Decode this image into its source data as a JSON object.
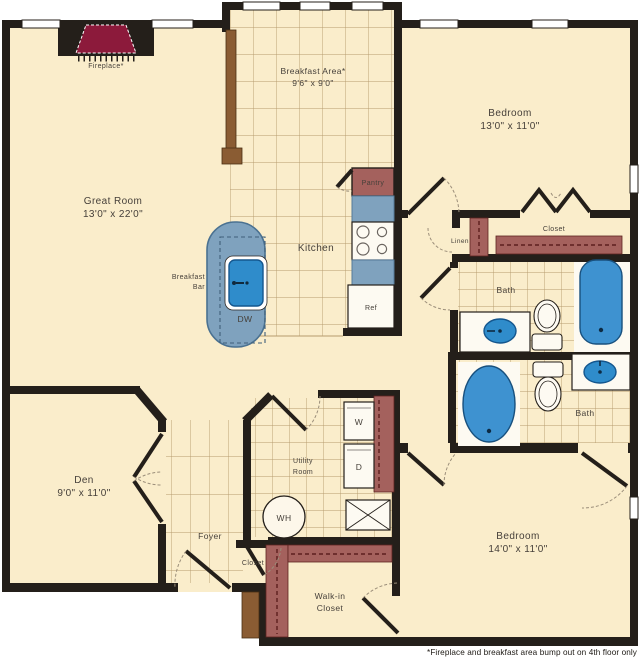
{
  "plan": {
    "footnote": "*Fireplace and breakfast area bump out on 4th floor only",
    "colors": {
      "floor": "#FAEDCB",
      "wall": "#241F1A",
      "counter_blue": "#7FA2BE",
      "fixture_blue": "#2F8CCB",
      "tub_blue": "#3E92D0",
      "shelf_red": "#A4615D",
      "fireplace_red": "#8C1A3B",
      "wood_brown": "#8A5C33"
    },
    "rooms": {
      "great_room": {
        "name": "Great Room",
        "dims": "13'0\" x 22'0\""
      },
      "breakfast_area": {
        "name": "Breakfast Area*",
        "dims": "9'6\" x 9'0\""
      },
      "kitchen": {
        "name": "Kitchen"
      },
      "bedroom1": {
        "name": "Bedroom",
        "dims": "13'0\" x 11'0\""
      },
      "bedroom2": {
        "name": "Bedroom",
        "dims": "14'0\" x 11'0\""
      },
      "den": {
        "name": "Den",
        "dims": "9'0\" x 11'0\""
      },
      "foyer": {
        "name": "Foyer"
      },
      "utility": {
        "line1": "Utility",
        "line2": "Room"
      },
      "bath1": {
        "name": "Bath"
      },
      "bath2": {
        "name": "Bath"
      },
      "closet_bedroom1": {
        "name": "Closet"
      },
      "closet_foyer": {
        "name": "Closet"
      },
      "walkin_closet": {
        "line1": "Walk-in",
        "line2": "Closet"
      },
      "linen": {
        "name": "Linen"
      },
      "pantry": {
        "name": "Pantry"
      },
      "breakfast_bar": {
        "line1": "Breakfast",
        "line2": "Bar"
      },
      "fireplace": {
        "name": "Fireplace*"
      }
    },
    "appliances": {
      "washer": "W",
      "dryer": "D",
      "water_heater": "WH",
      "dishwasher": "DW",
      "refrigerator": "Ref"
    }
  }
}
